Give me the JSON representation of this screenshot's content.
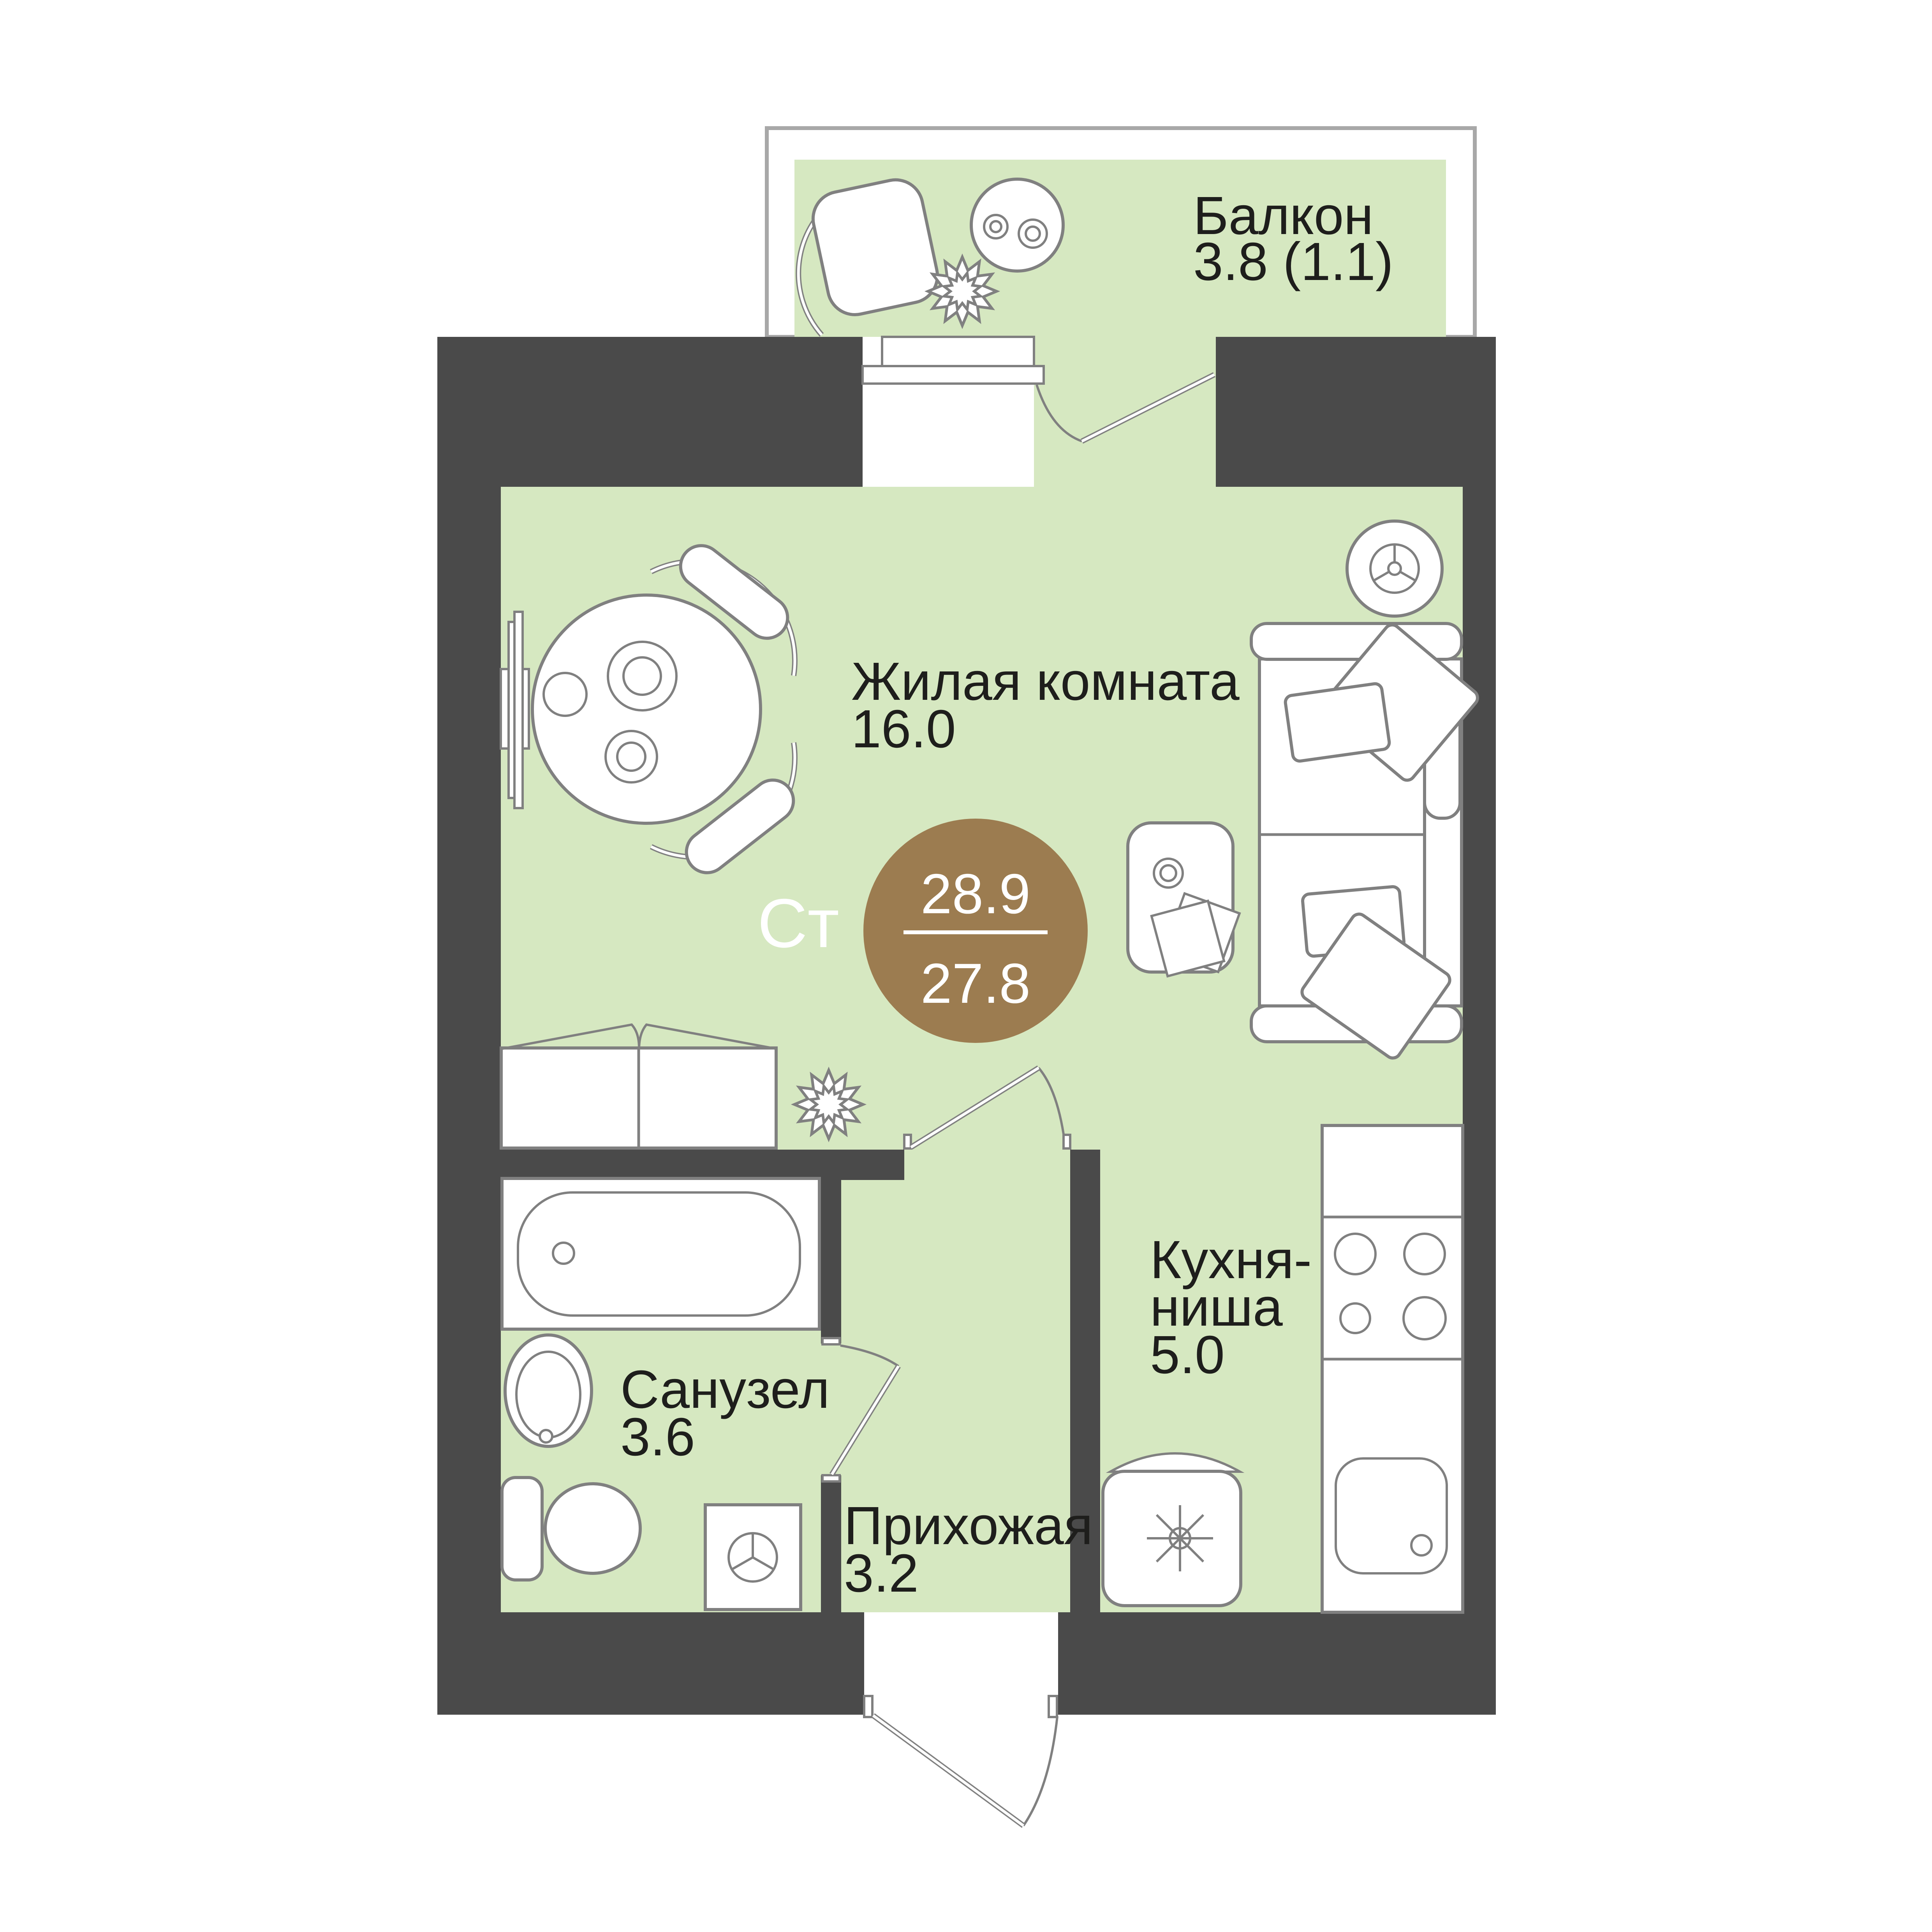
{
  "plan": {
    "badge": {
      "type_label": "Ст",
      "total_area": "28.9",
      "living_area": "27.8"
    },
    "rooms": {
      "balcony": {
        "name": "Балкон",
        "area": "3.8 (1.1)"
      },
      "living": {
        "name": "Жилая комната",
        "area": "16.0"
      },
      "kitchen": {
        "name_line1": "Кухня-",
        "name_line2": "ниша",
        "area": "5.0"
      },
      "bathroom": {
        "name": "Санузел",
        "area": "3.6"
      },
      "hall": {
        "name": "Прихожая",
        "area": "3.2"
      }
    }
  },
  "colors": {
    "wall": "#4a4a4a",
    "room": "#d6e8c1",
    "accent": "#9c7c50",
    "ink": "#1e1e1c",
    "outline": "#808080",
    "frame": "#a8a8a8",
    "paper": "#ffffff"
  }
}
